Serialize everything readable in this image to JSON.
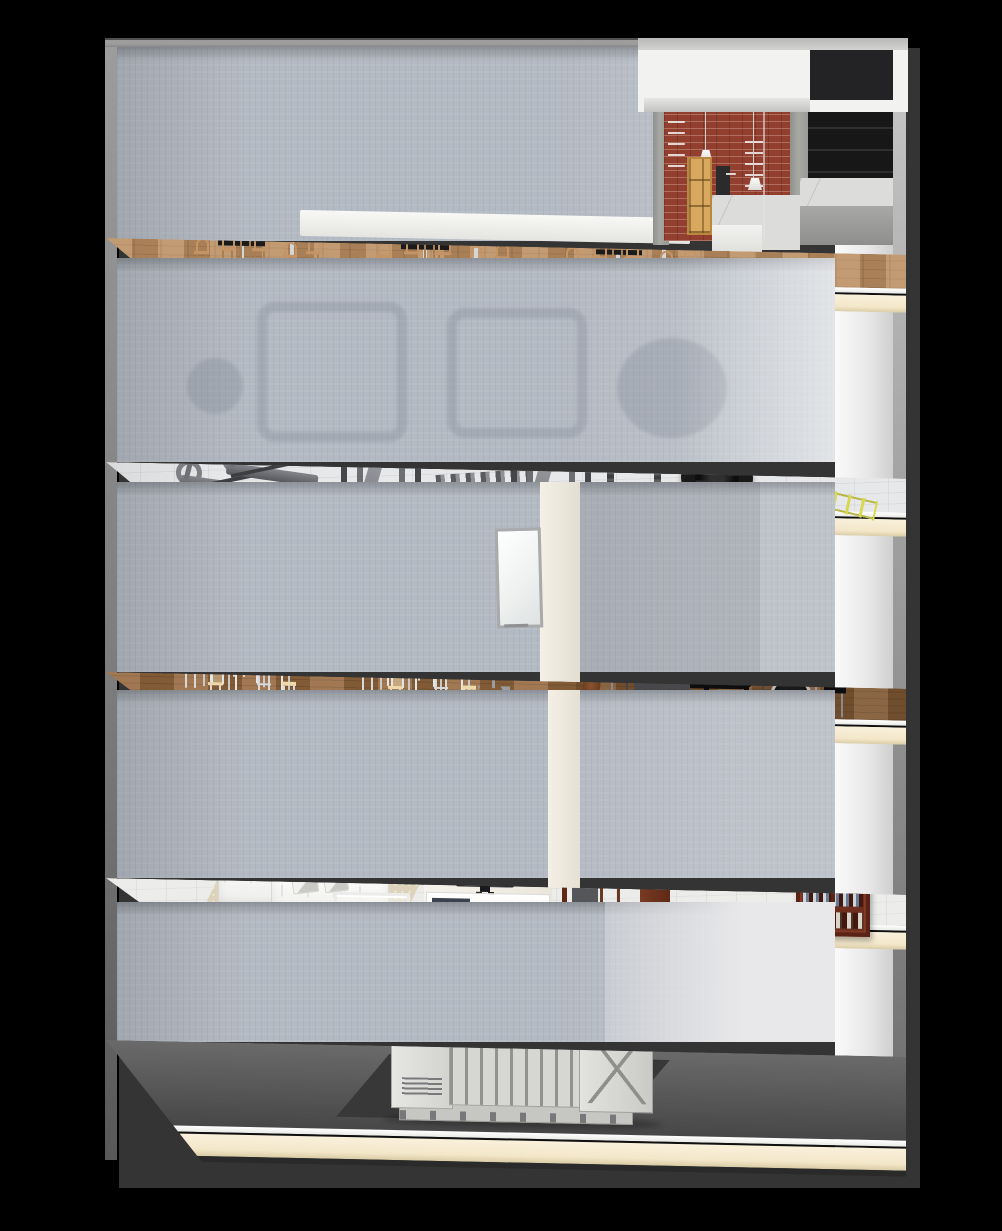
{
  "scene": {
    "type": "3d-building-cutaway",
    "description": "Five-storey dollhouse cross-section render on black background",
    "floors": [
      {
        "id": "floor-5",
        "name": "cafe",
        "label": "Top floor: cafe with dining tables, bentwood chairs and brick coffee bar with menu wall, marble counter, pendant lamps"
      },
      {
        "id": "floor-4",
        "name": "gym",
        "label": "Gym floor: treadmills, two smith-machine cages, dumbbell rack, power rack with purple plates on lifting platform, tractor tyre, stools, agility ladder, basketball, blue mat"
      },
      {
        "id": "floor-3",
        "name": "classroom-and-music-studio",
        "label": "Classroom with six desks, stools, whiteboard and projector stand; music studio with grand piano, organ console, microphone booms, music stands, guitar and drum kit"
      },
      {
        "id": "floor-2",
        "name": "living-room-and-study",
        "label": "Living room with white sofas, coffee table, rug and TV wall unit; study with dark wood desk, red lamp, bar stool and mahogany bookshelf"
      },
      {
        "id": "floor-1",
        "name": "generator-basement",
        "label": "Basement plant room with industrial generator set on dark pad"
      }
    ],
    "colors": {
      "background": "#000000",
      "drop_shadow": "#343434",
      "wallpaper": "#b4bac3",
      "slab_cream": "#f7eed9",
      "cafe_wood": "#bb8d60",
      "classroom_wood": "#96693f",
      "brick": "#933f2f",
      "plate_purple": "#7a72c8",
      "ladder_yellow": "#d8d855",
      "basketball_red": "#b5402e",
      "mat_blue": "#a9c1ec",
      "bookshelf_mahogany": "#6e2f1e",
      "lamp_red": "#8e2525",
      "generator_gray": "#d6d6d2"
    }
  }
}
